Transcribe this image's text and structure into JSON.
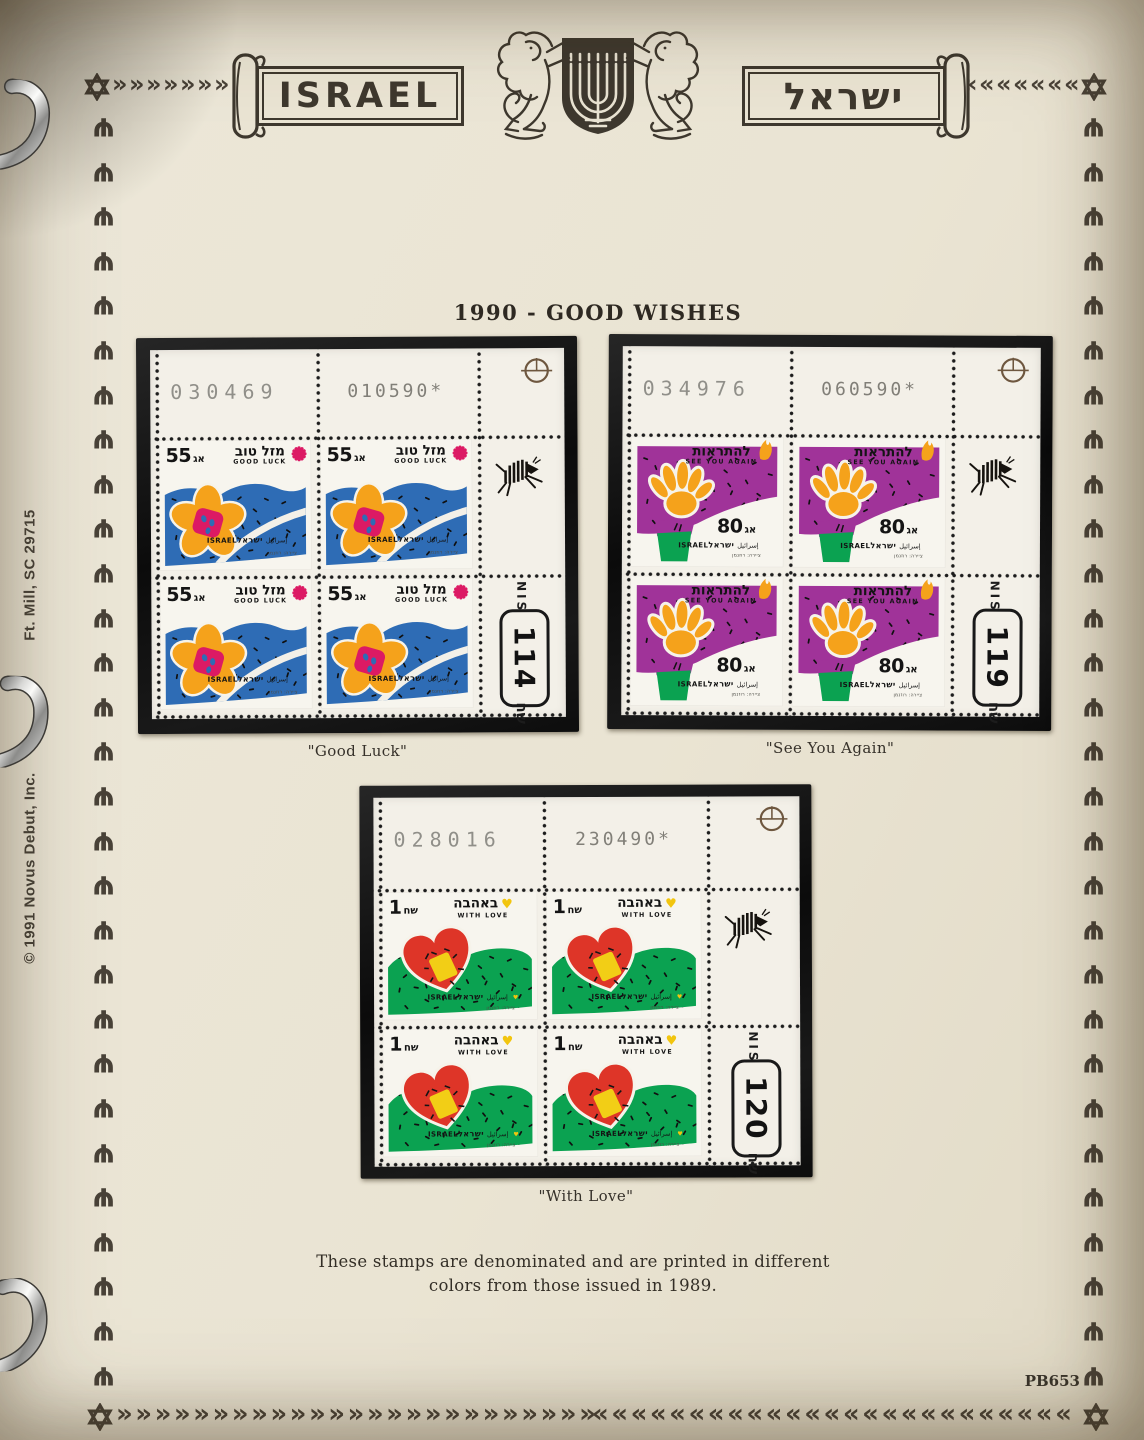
{
  "title": "1990 - GOOD WISHES",
  "header": {
    "banner_left": "ISRAEL",
    "banner_right": "ישראל",
    "emblem": "two-lions-flanking-menorah-shield"
  },
  "blocks": [
    {
      "caption": "\"Good Luck\"",
      "selvage": {
        "serial": "030469",
        "date": "010590*",
        "currency": "NIS",
        "plate": "114",
        "sheqel": "שח"
      },
      "stamp": {
        "design": "good-luck",
        "denom_number": "55",
        "denom_unit": "אג",
        "unit_first": false,
        "greeting_hebrew": "מזל טוב",
        "greeting_english": "GOOD LUCK",
        "country_latin": "ISRAEL",
        "country_arabic": "إسرائيل",
        "country_hebrew": "ישראל",
        "credit": "ציירה: רוזנמן",
        "colors": {
          "field": "#2e6cb5",
          "motif": "#f5a21b",
          "accent": "#dc1a64",
          "patch": "#f2ce16"
        }
      }
    },
    {
      "caption": "\"See You Again\"",
      "selvage": {
        "serial": "034976",
        "date": "060590*",
        "currency": "NIS",
        "plate": "119",
        "sheqel": "שח"
      },
      "stamp": {
        "design": "see-you-again",
        "denom_number": "80",
        "denom_unit": "אג",
        "unit_first": false,
        "greeting_hebrew": "להתראות",
        "greeting_english": "SEE YOU AGAIN",
        "country_latin": "ISRAEL",
        "country_arabic": "إسرائيل",
        "country_hebrew": "ישראל",
        "credit": "ציירה: רוזנמן",
        "colors": {
          "field": "#a03399",
          "motif": "#f5a21b",
          "accent": "#0ba251",
          "patch": "#f2ce16"
        }
      }
    },
    {
      "caption": "\"With Love\"",
      "selvage": {
        "serial": "028016",
        "date": "230490*",
        "currency": "NIS",
        "plate": "120",
        "sheqel": "שח"
      },
      "stamp": {
        "design": "with-love",
        "denom_number": "1",
        "denom_unit": "שח",
        "unit_first": true,
        "greeting_hebrew": "באהבה",
        "greeting_english": "WITH LOVE",
        "country_latin": "ISRAEL",
        "country_arabic": "إسرائيل",
        "country_hebrew": "ישראל",
        "credit": "ציירה: רוזנמן",
        "colors": {
          "field": "#0ba251",
          "motif": "#de3528",
          "accent": "#f2c50e",
          "patch": "#f2ce16"
        }
      }
    }
  ],
  "footnote": [
    "These stamps are denominated and are printed in different",
    "colors from those issued in 1989."
  ],
  "page_number": "PB653",
  "margin_notes": {
    "address": "Ft. Mill, SC 29715",
    "copyright": "© 1991 Novus Debut, Inc."
  },
  "colors": {
    "page_background": "#eae4d3",
    "border_ink": "#494238",
    "mount_black": "#121212",
    "sheet_white": "#f3f0e8",
    "serial_gray": "#908f89"
  }
}
